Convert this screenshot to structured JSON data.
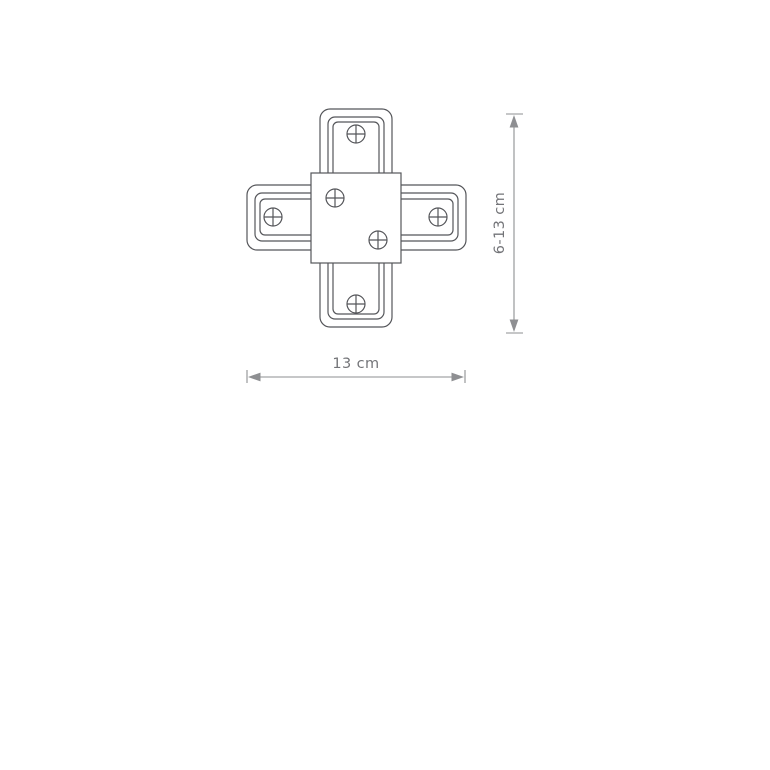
{
  "page": {
    "background": "#ffffff"
  },
  "diagram": {
    "colors": {
      "outline": "#55565a",
      "dimension": "#8e8f92",
      "text": "#737478"
    },
    "screw_count": 6,
    "icons": {
      "screw": "circle-with-plus-cross",
      "arrow_up": "▲",
      "arrow_down": "▼",
      "arrow_left": "◀",
      "arrow_right": "▶"
    },
    "width_dimension": {
      "label": "13 cm"
    },
    "height_dimension": {
      "label": "6-13 cm"
    }
  }
}
